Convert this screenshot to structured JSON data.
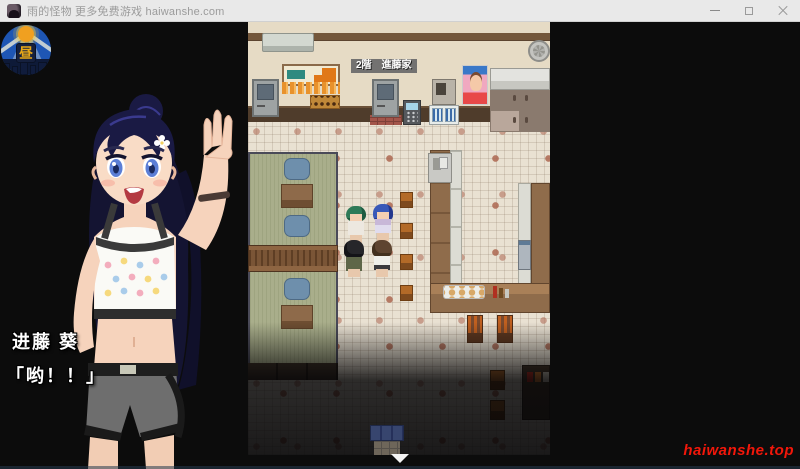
{
  "window": {
    "title": "雨的怪物 更多免费游戏 haiwanshe.com",
    "controls": {
      "minimize": "minimize",
      "maximize": "maximize",
      "close": "close"
    }
  },
  "hud": {
    "time_of_day_badge": "昼"
  },
  "map": {
    "floor_sign": "2階　進藤家",
    "scene": "restaurant-interior-second-floor",
    "exit_indicator": "down-arrow"
  },
  "dialog": {
    "speaker": "进藤 葵",
    "line": "「哟！！」"
  },
  "watermark": "haiwanshe.top",
  "colors": {
    "titlebar_bg": "#E9E9E9",
    "titlebar_text": "#9B9B9B",
    "game_bg": "#0C0C0C",
    "wall": "#E6DBC5",
    "wall_trim": "#74573B",
    "wainscot": "#4F3C2B",
    "floor_tile": "#E9E1D2",
    "floor_accent": "#AC6650",
    "tatami": "#A9AE8B",
    "cushion": "#6E8FAC",
    "wood": "#8F6C4B",
    "badge_sky": "#1E56B4",
    "badge_sun": "#F0A020",
    "badge_label": "#E8A818",
    "dialog_text": "#FFFFFF",
    "watermark_red": "#F2170A"
  }
}
